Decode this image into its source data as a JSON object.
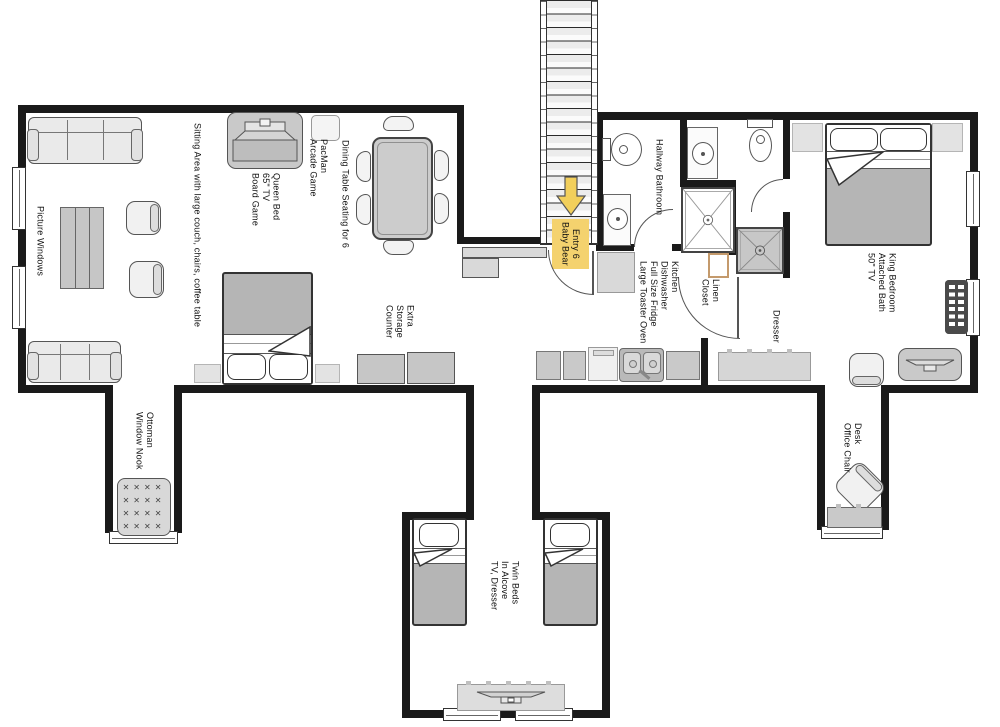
{
  "colors": {
    "wall": "#1a1a1a",
    "entry_highlight": "#f4d26e",
    "arrow": "#f2cf5b",
    "furniture_gray": "#cfcfcf",
    "blanket_gray": "#b5b5b5",
    "linen_trim": "#c49a6c"
  },
  "labels": {
    "sitting_area": "Sitting Area with large couch, chairs, coffee table",
    "picture_windows": "Picture Windows",
    "queen_room": "Queen Bed\n65\" TV\nBoard Game",
    "pacman": "PacMan\nArcade Game",
    "dining_table": "Dining Table Seating for 6",
    "extra_storage": "Extra\nStorage\nCounter",
    "ottoman_nook": "Ottoman\nWindow Nook",
    "entry": "Entry 6\nBaby Bear",
    "hallway_bathroom": "Hallway Bathroom",
    "kitchen": "Kitchen\nDishwasher\nFull Size Fridge\nLarge Toaster Oven",
    "linen_closet": "Linen\nCloset",
    "king_bedroom": "King Bedroom\nAttached Bath\n50\" TV",
    "dresser": "Dresser",
    "desk": "Desk\nOffice Chair",
    "twin_beds": "Twin Beds\nIn Alcove\nTV, Dresser"
  },
  "decor": {
    "ottoman_tufts": "✕✕✕✕\n✕✕✕✕\n✕✕✕✕\n✕✕✕✕"
  }
}
